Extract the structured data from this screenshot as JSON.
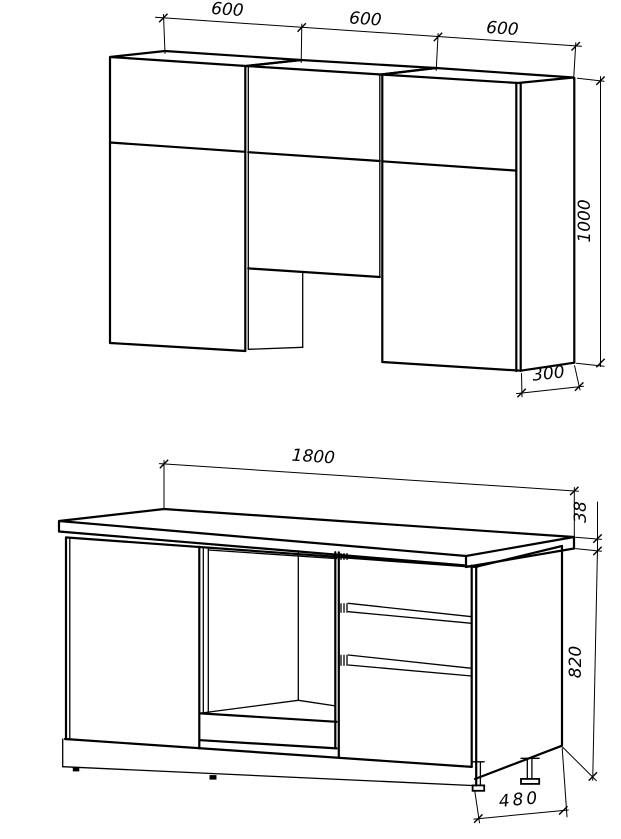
{
  "drawing": {
    "title": "kitchen-set-technical-drawing",
    "line_color": "#000000",
    "background_color": "#ffffff",
    "wall_units": {
      "width_left_mm": "600",
      "width_middle_mm": "600",
      "width_right_mm": "600",
      "height_mm": "1000",
      "depth_mm": "300"
    },
    "base_units": {
      "width_mm": "1800",
      "countertop_thickness_mm": "38",
      "body_height_mm": "820",
      "depth_mm": "480"
    }
  }
}
